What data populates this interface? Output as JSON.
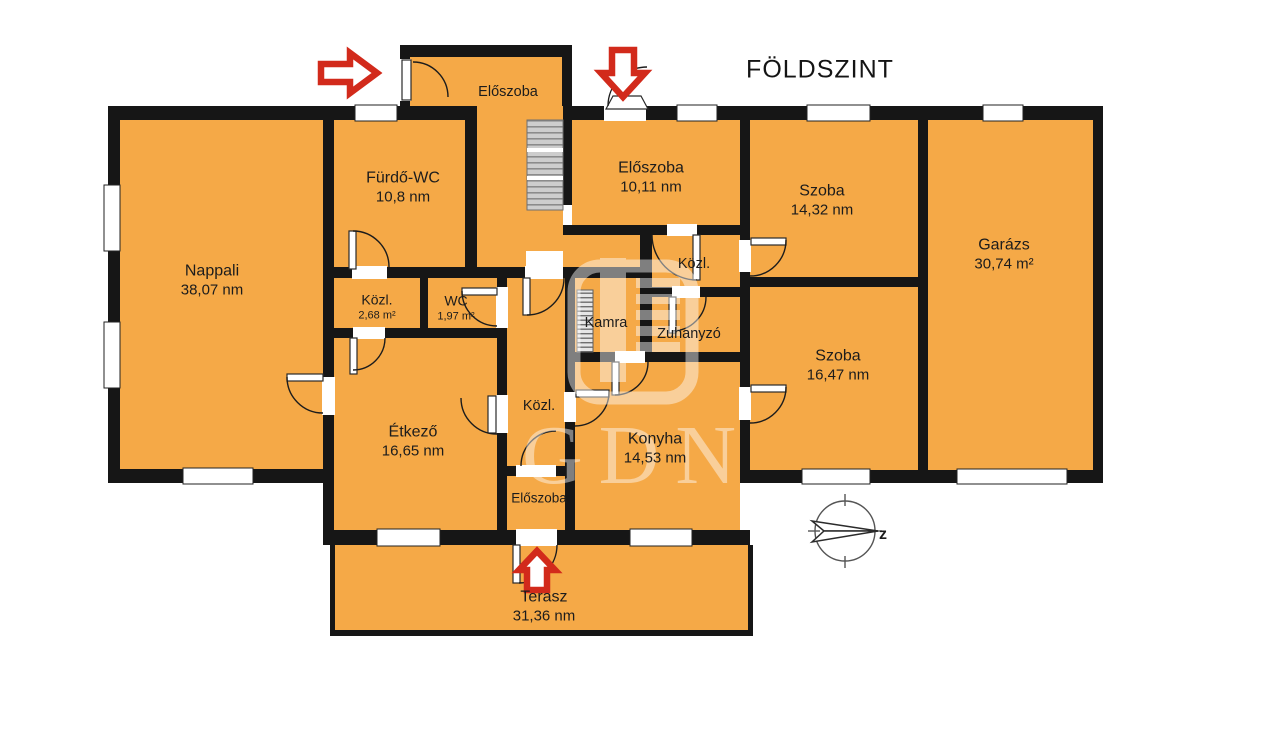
{
  "title": "FÖLDSZINT",
  "compass": {
    "label": "z"
  },
  "watermark": {
    "text": "GDN"
  },
  "colors": {
    "room_fill": "#F5A947",
    "wall": "#161616",
    "arrow_red": "#D22A1B",
    "stairs_gray": "#CDCDCD"
  },
  "rooms": [
    {
      "name": "Nappali",
      "area": "38,07 nm"
    },
    {
      "name": "Fürdő-WC",
      "area": "10,8 nm"
    },
    {
      "name": "Előszoba",
      "area": ""
    },
    {
      "name": "Előszoba",
      "area": "10,11 nm"
    },
    {
      "name": "Szoba",
      "area": "14,32 nm"
    },
    {
      "name": "Garázs",
      "area": "30,74 m²"
    },
    {
      "name": "Közl.",
      "area": "2,68 m²"
    },
    {
      "name": "WC",
      "area": "1,97 m²"
    },
    {
      "name": "Kamra",
      "area": ""
    },
    {
      "name": "Zuhanyzó",
      "area": ""
    },
    {
      "name": "Közl.",
      "area": ""
    },
    {
      "name": "Szoba",
      "area": "16,47 nm"
    },
    {
      "name": "Étkező",
      "area": "16,65 nm"
    },
    {
      "name": "Közl.",
      "area": ""
    },
    {
      "name": "Konyha",
      "area": "14,53 nm"
    },
    {
      "name": "Előszoba",
      "area": ""
    },
    {
      "name": "Terasz",
      "area": "31,36 nm"
    }
  ]
}
